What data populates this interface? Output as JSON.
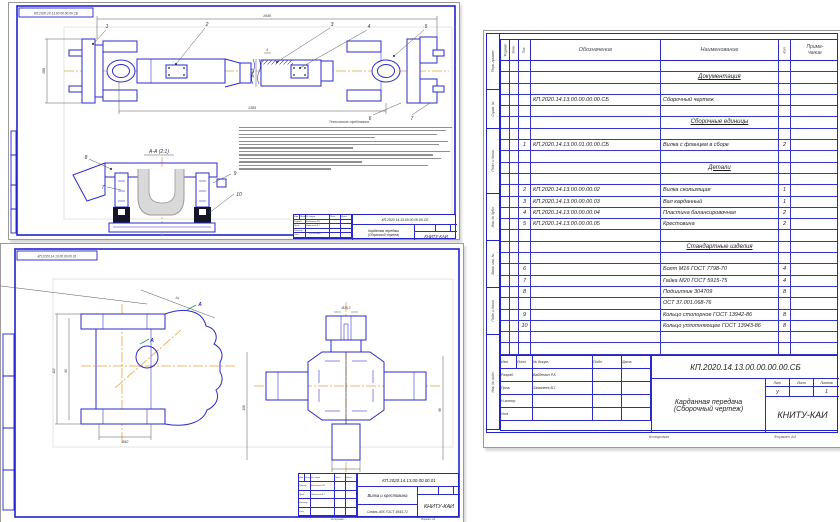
{
  "palette": {
    "line_blue": "#2b2bcc",
    "frame_blue": "#2323cc",
    "centerline_orange": "#e8a43c",
    "text": "#222222"
  },
  "assembly_sheet": {
    "corner_stamp": "КП.2020.14.13.00.00.00.00.СБ",
    "callouts": [
      "1",
      "2",
      "3",
      "4",
      "5",
      "6",
      "7"
    ],
    "dims": {
      "overall": "1640",
      "secondary": "1385",
      "flange": "180",
      "tube_dia": "Ø71,5",
      "wall": "4"
    },
    "section": {
      "label": "А-А (2:1)",
      "callouts": [
        "8",
        "7",
        "9",
        "10"
      ]
    },
    "notes_title": "Технические требования",
    "title_block": {
      "doc_number": "КП.2020.14.13.00.00.00.00.СБ",
      "name_line1": "Карданная передача",
      "name_line2": "(Сборочный чертеж)",
      "org": "КНИТУ-КАИ"
    }
  },
  "details_sheet": {
    "corner_stamp": "КП.2020.14.13.00.00.00.01",
    "view_label": "А",
    "dims": {
      "yoke_height": "112",
      "yoke_inner": "90",
      "yoke_width": "Ø42",
      "yoke_angle": "64",
      "cross_height": "108",
      "cross_width": "96",
      "hole": "Ø16,3",
      "trunnion": "Ø25",
      "trunnion_note": "4 шт."
    },
    "title_block": {
      "doc_number": "КП.2020.14.13.00.00.00.01",
      "name": "Вилка и крестовина",
      "material": "Сталь 40Х ГОСТ 4543-71",
      "org": "КНИТУ-КАИ"
    }
  },
  "spec_sheet": {
    "columns": {
      "format": "Формат",
      "zone": "Зона",
      "pos": "Поз.",
      "designation": "Обозначение",
      "name": "Наименование",
      "qty": "Кол.",
      "note1": "Приме-",
      "note2": "чание"
    },
    "side_labels": [
      "Перв. примен.",
      "Справ. №",
      "Подп. и дата",
      "Инв. № дубл.",
      "Взам. инв. №",
      "Подп. и дата",
      "Инв. № подл."
    ],
    "rows": [
      {
        "pos": "",
        "designation": "",
        "name": "",
        "qty": "",
        "style": ""
      },
      {
        "pos": "",
        "designation": "",
        "name": "Документация",
        "qty": "",
        "style": "section"
      },
      {
        "pos": "",
        "designation": "",
        "name": "",
        "qty": "",
        "style": ""
      },
      {
        "pos": "",
        "designation": "КП.2020.14.13.00.00.00.00.СБ",
        "name": "Сборочный чертеж",
        "qty": "",
        "style": ""
      },
      {
        "pos": "",
        "designation": "",
        "name": "",
        "qty": "",
        "style": ""
      },
      {
        "pos": "",
        "designation": "",
        "name": "Сборочные единицы",
        "qty": "",
        "style": "section"
      },
      {
        "pos": "",
        "designation": "",
        "name": "",
        "qty": "",
        "style": ""
      },
      {
        "pos": "1",
        "designation": "КП.2020.14.13.00.01.00.00.СБ",
        "name": "Вилка с фланцем в сборе",
        "qty": "2",
        "style": ""
      },
      {
        "pos": "",
        "designation": "",
        "name": "",
        "qty": "",
        "style": ""
      },
      {
        "pos": "",
        "designation": "",
        "name": "Детали",
        "qty": "",
        "style": "section"
      },
      {
        "pos": "",
        "designation": "",
        "name": "",
        "qty": "",
        "style": ""
      },
      {
        "pos": "2",
        "designation": "КП.2020.14.13.00.00.00.02",
        "name": "Вилка скользящая",
        "qty": "1",
        "style": ""
      },
      {
        "pos": "3",
        "designation": "КП.2020.14.13.00.00.00.03",
        "name": "Вал карданный",
        "qty": "1",
        "style": ""
      },
      {
        "pos": "4",
        "designation": "КП.2020.14.13.00.00.00.04",
        "name": "Пластина балансировочная",
        "qty": "2",
        "style": ""
      },
      {
        "pos": "5",
        "designation": "КП.2020.14.13.00.00.00.05",
        "name": "Крестовина",
        "qty": "2",
        "style": ""
      },
      {
        "pos": "",
        "designation": "",
        "name": "",
        "qty": "",
        "style": ""
      },
      {
        "pos": "",
        "designation": "",
        "name": "Стандартные изделия",
        "qty": "",
        "style": "section"
      },
      {
        "pos": "",
        "designation": "",
        "name": "",
        "qty": "",
        "style": ""
      },
      {
        "pos": "6",
        "designation": "",
        "name": "Болт М16 ГОСТ 7798-70",
        "qty": "4",
        "style": ""
      },
      {
        "pos": "7",
        "designation": "",
        "name": "Гайка М20 ГОСТ 5915-75",
        "qty": "4",
        "style": ""
      },
      {
        "pos": "8",
        "designation": "",
        "name": "Подшипник 304709",
        "qty": "8",
        "style": ""
      },
      {
        "pos": "",
        "designation": "",
        "name": "ОСТ 37.001.068-76",
        "qty": "",
        "style": ""
      },
      {
        "pos": "9",
        "designation": "",
        "name": "Кольцо стопорное ГОСТ 13942-86",
        "qty": "8",
        "style": ""
      },
      {
        "pos": "10",
        "designation": "",
        "name": "Кольцо уплотняющее ГОСТ 13943-86",
        "qty": "8",
        "style": ""
      },
      {
        "pos": "",
        "designation": "",
        "name": "",
        "qty": "",
        "style": ""
      },
      {
        "pos": "",
        "designation": "",
        "name": "",
        "qty": "",
        "style": ""
      }
    ],
    "title_block": {
      "doc_number": "КП.2020.14.13.00.00.00.00.СБ",
      "name_line1": "Карданная передача",
      "name_line2": "(Сборочный чертеж)",
      "org": "КНИТУ-КАИ",
      "header_cells": [
        "Изм.",
        "Лист",
        "№ докум.",
        "Подп.",
        "Дата"
      ],
      "sig_rows": [
        {
          "role": "Разраб.",
          "name": "Вайдемян Р.К."
        },
        {
          "role": "Пров.",
          "name": "Замалеев В.Г."
        },
        {
          "role": "Н.контр.",
          "name": ""
        },
        {
          "role": "Утв.",
          "name": ""
        }
      ],
      "lit_cells": [
        "Лит.",
        "Лист",
        "Листов"
      ],
      "lit_value": "у",
      "sheets_value": "1",
      "footer_left": "Копировал",
      "footer_right": "Формат А4"
    }
  }
}
